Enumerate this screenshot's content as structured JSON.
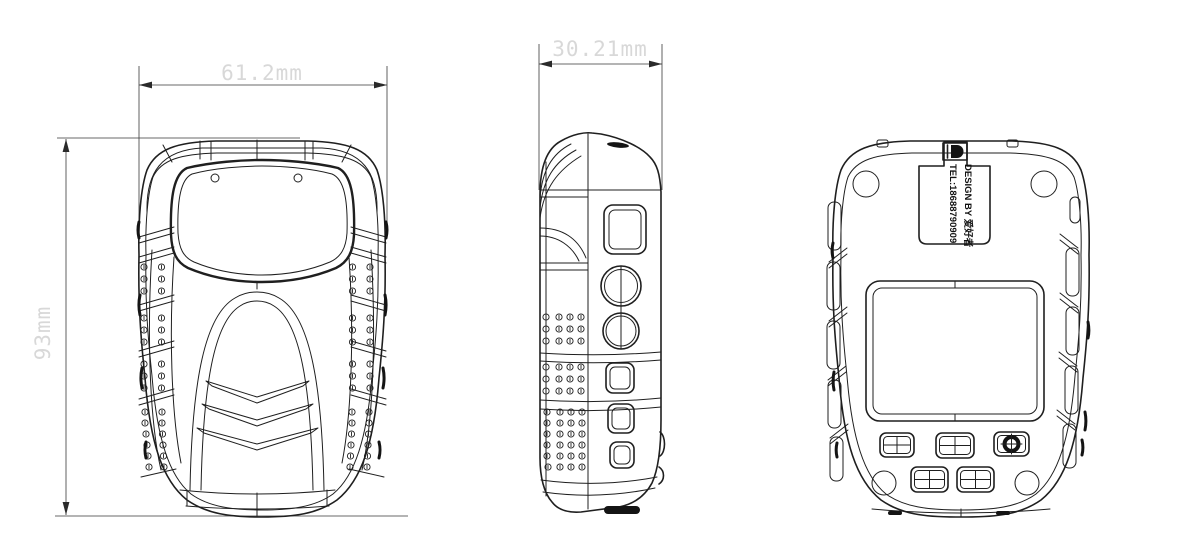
{
  "drawing": {
    "background": "#ffffff",
    "line_color": "#1f1f1f",
    "dimension_text_color": "#d8d8d8"
  },
  "dimensions": {
    "front_width": "61.2mm",
    "height": "93mm",
    "depth": "30.21mm"
  },
  "back_label": {
    "line1": "DESIGN BY 爱好者",
    "line2": "TEL:18688790909"
  }
}
